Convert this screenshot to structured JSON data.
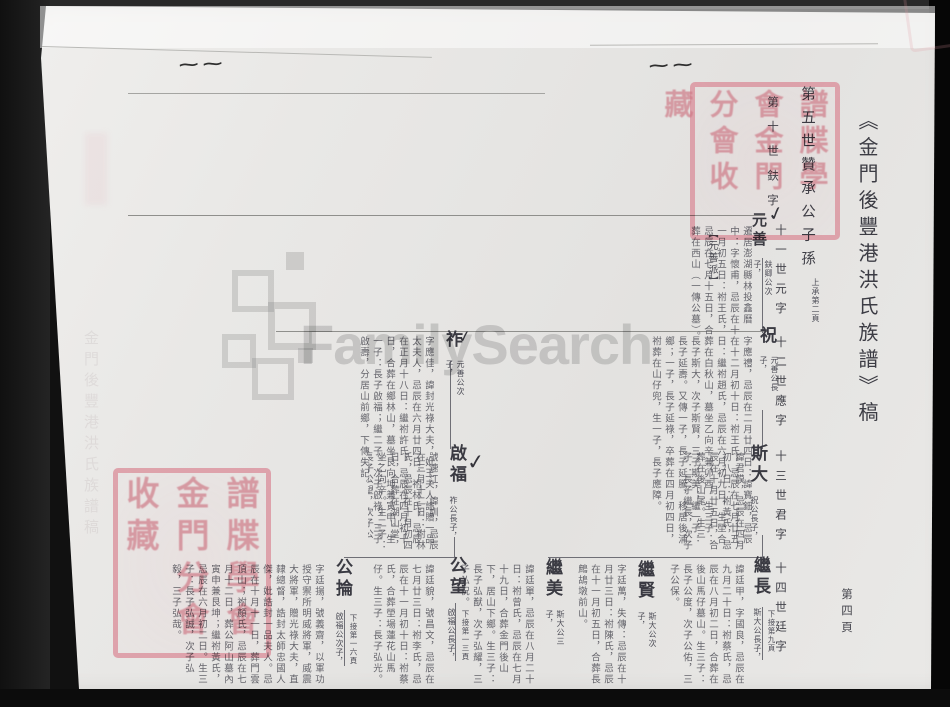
{
  "page": {
    "title": "《金門後豐港洪氏族譜》稿",
    "page_number": "第四頁",
    "header": "第五世贊承公子孫",
    "header_note": "上承第二頁",
    "branch_note": "【元善派】",
    "generation_markers": [
      "第十世鈇字",
      "十一世元字",
      "十二世應字",
      "十三世君字",
      "十四世廷字"
    ],
    "ghost_text": "金門後豐港洪氏族譜稿"
  },
  "tree": {
    "persons": [
      {
        "name": "元善",
        "annotation": "鈇卿公次子，",
        "bio": "遷居澎湖縣林投鑫曆中：字懷甫，忌辰在十一月初五日：祔王氏，忌辰在七月十五日，合葬在西山（一傳公墓）。生四子。"
      },
      {
        "name": "祝",
        "annotation": "元善公長子，",
        "bio": "字應禮，忌辰在二月廿四日：諱寶鈿，忌辰在十二月初十日：祔王氏，忌辰在七月廿五日：繼祔趙氏，忌辰在六月初九日，生塋合葬在白秋山，墓坐乙向辛兼卯酉。生三子：長子斯大，次子斯賢，三子斯美；繼一子：長子延壽。又傳一子，長子延騰，移居後浦鄉；一子，長子延祿，卒葬在四月初四日，祔葬在山仔兜，生一子，長子應障。"
      },
      {
        "name": "祚",
        "annotation": "元善公次子，",
        "bio": "字應佳，諱封光祿大夫，妣王夫人誥贈一品太夫人，忌辰在六月廿四日：祔林氏，忌辰在正月十八日：繼祔許氏，忌辰在四月初十日，合葬在鄉林山，墓坐艮向坤兼寅申。生一子：長子啟福；繼二子：次子啟祿，三子啟壽，分居山前鄉，下傳失記。"
      },
      {
        "name": "斯大",
        "annotation": "祝公長子，",
        "bio": "諱君謨，忌辰在四月初八日：祔黃氏，忌辰在十月廿五日，合葬在後山尾。生三子：長子繼長，次子繼賢，三子繼美。"
      },
      {
        "name": "啟福",
        "annotation": "祚公長子，",
        "bio": "號速江，諱訓，忌辰在三月十二日：祔林氏，忌辰在十月初四日，合葬在湖山堂，坐乙向辛。生二子：長子公望，次子公掄。"
      },
      {
        "name": "繼長",
        "annotation": "斯大公長子，",
        "continuation": "下接第九頁",
        "bio": "諱廷甲，字國良，忌辰在九月二十日：祔蔡氏，忌辰在八月初二日，合葬在後山馬仔墓山。生三子：長子公度，次子公佑，三子公保。"
      },
      {
        "name": "繼賢",
        "annotation": "斯大公次子，",
        "bio": "字廷萬，失傳：忌辰在十月廿三日：祔陳氏，忌辰在十一月初五日，合葬長鷓鴣墩前山。"
      },
      {
        "name": "繼美",
        "annotation": "斯大公三子，",
        "bio": "諱廷單，忌辰在八月二十日：祔曾氏，忌辰在七月十九日，合葬金門後山下，居山下鄉。生三子：長子弘猷，次子弘耀，三子弘祝。"
      },
      {
        "name": "公望",
        "annotation": "啟福公長子，",
        "continuation": "下接第一三頁",
        "bio": "諱廷貌，號昌文，忌辰在七月廿三日：祔李氏，忌辰在十一月初十日：祔蔡氏，合葬塋場蓮花山馬仔。生三子：長子弘光。"
      },
      {
        "name": "公掄",
        "annotation": "啟福公次子，",
        "continuation": "下接第一六頁",
        "bio": "字廷揚，號義齋，以軍功授守禦所明威將軍，威震大將軍，贈光祿大夫，直隸總督，誥封太師忠國人傑，妣誥封一品夫人。忌辰在十月十一日，葬門雲頂山；祔顏氏，忌辰在七月十二日，葬公阿山墓內寅申兼艮坤；繼祔黃氏，忌辰在六月初二日。生三子：長子弘誠，次子弘毅，三子弘哉。"
      }
    ]
  },
  "watermark": {
    "text": "FamilySearch"
  },
  "seals": [
    {
      "name": "library-seal-top-right",
      "text": "譜牒學會金門分會收藏"
    },
    {
      "name": "library-seal-left",
      "text": "譜牒學會金門分會收藏"
    }
  ],
  "marks": {
    "checkmark": "✓",
    "squiggle": "~~"
  },
  "colors": {
    "seal_red": "#d98f9b",
    "ink": "#3a3a42",
    "page_bg": "#e7e6e3",
    "watermark_gray": "#8a8a8a",
    "background_dark": "#111111"
  }
}
